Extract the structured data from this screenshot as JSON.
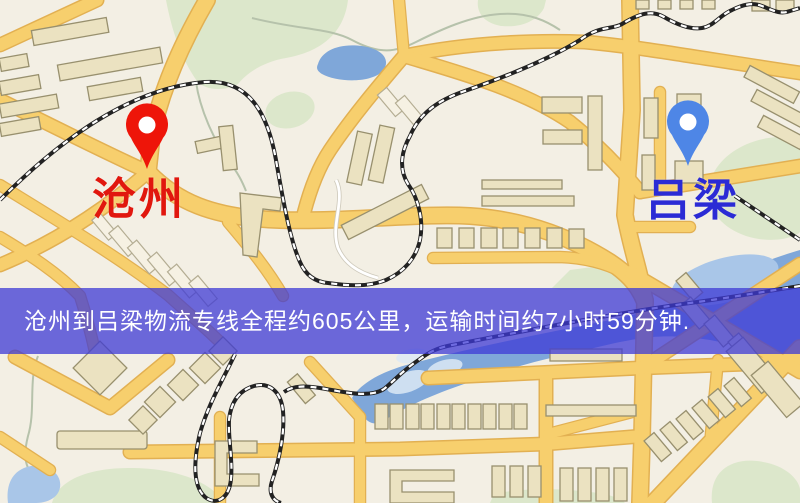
{
  "markers": {
    "origin": {
      "label": "沧州",
      "pin_color": "#ee1509",
      "label_color": "#e1170e"
    },
    "destination": {
      "label": "吕梁",
      "pin_color": "#4e86e6",
      "label_color": "#2b2bd5"
    }
  },
  "banner": {
    "text": "沧州到吕梁物流专线全程约605公里，运输时间约7小时59分钟.",
    "distance_km": "605",
    "duration_hours": "7",
    "duration_minutes": "59"
  },
  "colors": {
    "bg": "#f3efe4",
    "road-fill": "#f7cf6d",
    "road-casing": "#e2b052",
    "green": "#dce7cb",
    "stream": "#b6c2ab",
    "water": "#7fa7d9",
    "water-light": "#a9c6e8",
    "rail": "#222222",
    "bldg-fill": "#ebe2c1",
    "bldg-stroke": "#98906e",
    "banner-bg": "rgba(62,58,214,0.75)",
    "banner-text": "#ffffff",
    "origin-label": "#e1170e",
    "dest-label": "#2b2bd5"
  }
}
